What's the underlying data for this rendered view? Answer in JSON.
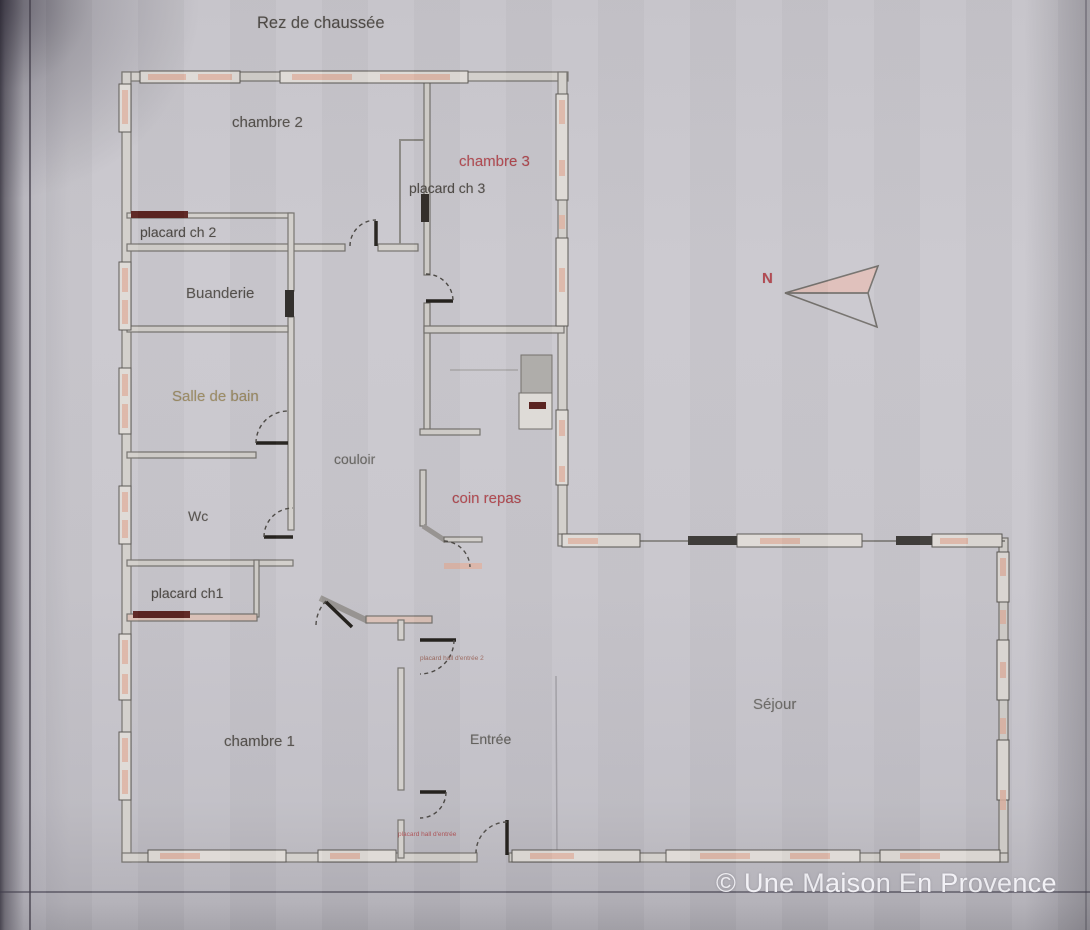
{
  "title": "Rez de chaussée",
  "watermark": "© Une Maison En Provence",
  "compass": {
    "north_label": "N"
  },
  "rooms": {
    "chambre2": "chambre 2",
    "chambre3": "chambre 3",
    "placard_ch3": "placard ch 3",
    "placard_ch2": "placard ch 2",
    "buanderie": "Buanderie",
    "salle_de_bain": "Salle de bain",
    "couloir": "couloir",
    "wc": "Wc",
    "coin_repas": "coin repas",
    "placard_ch1": "placard ch1",
    "chambre1": "chambre 1",
    "entree": "Entrée",
    "sejour": "Séjour"
  },
  "small_labels": {
    "hall_closet_2": "placard hall d'entrée 2",
    "hall_closet_1": "placard hall d'entrée"
  },
  "colors": {
    "accent_red": "#b0474f",
    "label_dark": "#4f4b47",
    "label_olive": "#9b8a62",
    "wall_gray": "#75726e",
    "wall_fill": "#d2cfcb",
    "window_pink": "#ddb2a2",
    "closet_dark_red": "#5c2522",
    "watermark_white": "#f7f6fa",
    "paper_gray": "#c9c7cd"
  }
}
